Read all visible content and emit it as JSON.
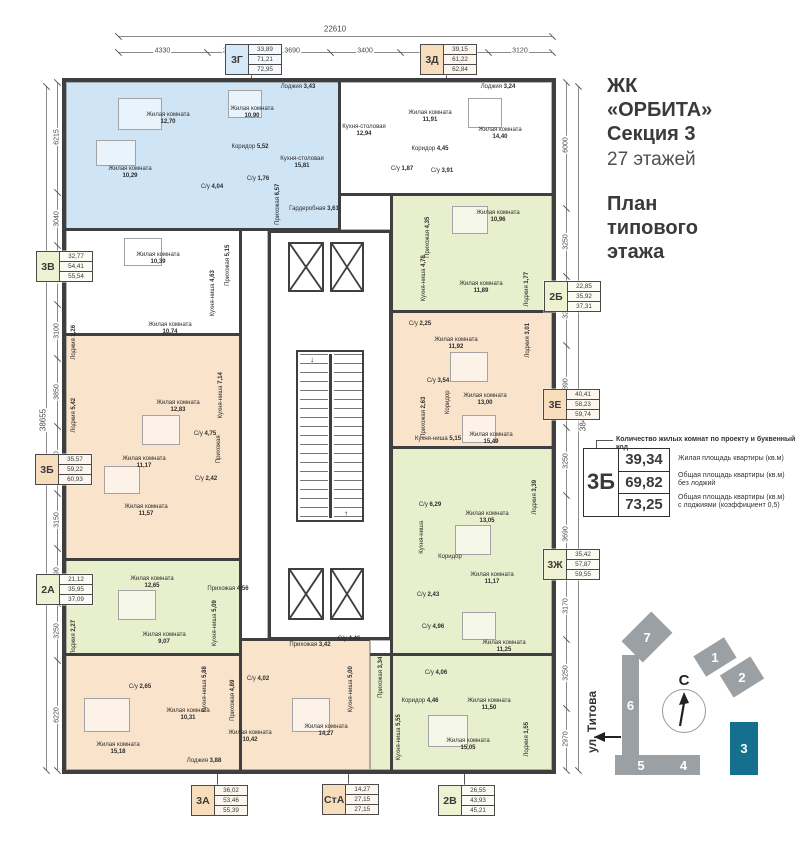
{
  "header": {
    "project_lines": [
      "ЖК",
      "«ОРБИТА»",
      "Секция 3"
    ],
    "floors": "27 этажей",
    "plan_lines": [
      "План",
      "типового",
      "этажа"
    ]
  },
  "legend": {
    "note": "Количество жилых комнат по проекту и буквенный код",
    "code": "3Б",
    "rows": [
      {
        "value": "39,34",
        "desc": "Жилая площадь квартиры (кв.м)"
      },
      {
        "value": "69,82",
        "desc": "Общая площадь квартиры (кв.м)\nбез лоджий"
      },
      {
        "value": "73,25",
        "desc": "Общая площадь квартиры (кв.м)\nс лоджиями (коэффициент 0,5)"
      }
    ]
  },
  "site": {
    "north": "С",
    "street": "ул. Титова",
    "buildings": [
      {
        "label": "1",
        "x": 112,
        "y": 55,
        "w": 36,
        "h": 24,
        "rot": -32
      },
      {
        "label": "2",
        "x": 139,
        "y": 74,
        "w": 36,
        "h": 26,
        "rot": -32
      },
      {
        "label": "3",
        "x": 145,
        "y": 132,
        "w": 28,
        "h": 53,
        "rot": 0,
        "hl": true
      },
      {
        "label": "4",
        "x": 82,
        "y": 165,
        "w": 33,
        "h": 20,
        "rot": 0
      },
      {
        "label": "5",
        "x": 30,
        "y": 165,
        "w": 52,
        "h": 20,
        "rot": 0
      },
      {
        "label": "6",
        "x": 37,
        "y": 65,
        "w": 17,
        "h": 100,
        "rot": 0
      },
      {
        "label": "7",
        "x": 41,
        "y": 32,
        "w": 42,
        "h": 30,
        "rot": -45
      }
    ]
  },
  "colors": {
    "wall": "#3f3f3f",
    "blue": "#cfe4f5",
    "orange": "#f9e3ca",
    "green": "#e8efcd",
    "white": "#ffffff",
    "labelBlue": "#d6e9f8",
    "labelOrange": "#f8ddbd",
    "labelGreen": "#eef2d2",
    "teal": "#15708f",
    "buildingGray": "#9aa0a4"
  },
  "dims": {
    "top": {
      "total": "22610",
      "segments": [
        "4330",
        "2300",
        "3690",
        "3400",
        "4280",
        "3120"
      ]
    },
    "left": {
      "total": "38655",
      "segments": [
        "6215",
        "3040",
        "3290",
        "3100",
        "3850",
        "3750",
        "3150",
        "3090",
        "3250",
        "6220"
      ]
    },
    "right": {
      "total": "38440",
      "segments": [
        "6000",
        "3250",
        "3290",
        "3890",
        "3250",
        "3690",
        "3170",
        "3250",
        "2970"
      ]
    }
  },
  "apartments": [
    {
      "code": "3Г",
      "values": [
        "33,89",
        "71,21",
        "72,95"
      ],
      "theme": "labelBlue",
      "x": 225,
      "y": 44,
      "side": "top"
    },
    {
      "code": "3Д",
      "values": [
        "39,15",
        "61,22",
        "62,84"
      ],
      "theme": "labelOrange",
      "x": 420,
      "y": 44,
      "side": "top"
    },
    {
      "code": "3В",
      "values": [
        "32,77",
        "54,41",
        "55,54"
      ],
      "theme": "labelGreen",
      "x": 36,
      "y": 251,
      "side": "left"
    },
    {
      "code": "3Б",
      "values": [
        "35,57",
        "59,22",
        "60,93"
      ],
      "theme": "labelOrange",
      "x": 35,
      "y": 454,
      "side": "left"
    },
    {
      "code": "2А",
      "values": [
        "21,12",
        "35,95",
        "37,09"
      ],
      "theme": "labelGreen",
      "x": 36,
      "y": 574,
      "side": "left"
    },
    {
      "code": "2Б",
      "values": [
        "22,85",
        "35,92",
        "37,31"
      ],
      "theme": "labelGreen",
      "x": 544,
      "y": 281,
      "side": "right"
    },
    {
      "code": "3Е",
      "values": [
        "40,41",
        "58,23",
        "59,74"
      ],
      "theme": "labelOrange",
      "x": 543,
      "y": 389,
      "side": "right"
    },
    {
      "code": "3Ж",
      "values": [
        "35,42",
        "57,87",
        "59,55"
      ],
      "theme": "labelGreen",
      "x": 543,
      "y": 549,
      "side": "right"
    },
    {
      "code": "3А",
      "values": [
        "36,02",
        "53,46",
        "55,39"
      ],
      "theme": "labelOrange",
      "x": 191,
      "y": 785,
      "side": "bottom"
    },
    {
      "code": "СтА",
      "values": [
        "14,27",
        "27,15",
        "27,15"
      ],
      "theme": "labelOrange",
      "x": 322,
      "y": 784,
      "side": "bottom"
    },
    {
      "code": "2В",
      "values": [
        "26,55",
        "43,93",
        "45,21"
      ],
      "theme": "labelGreen",
      "x": 438,
      "y": 785,
      "side": "bottom"
    }
  ],
  "floor_plan": {
    "zones": [
      {
        "id": "3g",
        "fill": "blue",
        "x": 66,
        "y": 82,
        "w": 274,
        "h": 148
      },
      {
        "id": "3d",
        "fill": "white",
        "x": 340,
        "y": 82,
        "w": 212,
        "h": 113
      },
      {
        "id": "corr-top",
        "fill": "white",
        "x": 340,
        "y": 195,
        "w": 52,
        "h": 35
      },
      {
        "id": "3v",
        "fill": "white",
        "x": 66,
        "y": 230,
        "w": 174,
        "h": 105
      },
      {
        "id": "3b",
        "fill": "orange",
        "x": 66,
        "y": 335,
        "w": 174,
        "h": 225
      },
      {
        "id": "2a",
        "fill": "green",
        "x": 66,
        "y": 560,
        "w": 174,
        "h": 95
      },
      {
        "id": "3a",
        "fill": "orange",
        "x": 66,
        "y": 655,
        "w": 174,
        "h": 115
      },
      {
        "id": "corr-left",
        "fill": "white",
        "x": 240,
        "y": 230,
        "w": 28,
        "h": 410
      },
      {
        "id": "sta",
        "fill": "orange",
        "x": 240,
        "y": 640,
        "w": 130,
        "h": 130
      },
      {
        "id": "sliver",
        "fill": "white",
        "x": 370,
        "y": 640,
        "w": 22,
        "h": 15
      },
      {
        "id": "2v",
        "fill": "green",
        "x": 370,
        "y": 655,
        "w": 182,
        "h": 115
      },
      {
        "id": "3zh",
        "fill": "green",
        "x": 392,
        "y": 448,
        "w": 160,
        "h": 207
      },
      {
        "id": "3e",
        "fill": "orange",
        "x": 392,
        "y": 312,
        "w": 160,
        "h": 136
      },
      {
        "id": "2b",
        "fill": "green",
        "x": 392,
        "y": 195,
        "w": 160,
        "h": 117
      }
    ],
    "walls": [
      [
        66,
        228,
        274,
        3
      ],
      [
        340,
        193,
        212,
        3
      ],
      [
        338,
        82,
        3,
        149
      ],
      [
        239,
        230,
        3,
        540
      ],
      [
        390,
        195,
        3,
        575
      ],
      [
        66,
        333,
        174,
        3
      ],
      [
        66,
        558,
        174,
        3
      ],
      [
        66,
        653,
        174,
        3
      ],
      [
        240,
        638,
        130,
        3
      ],
      [
        370,
        653,
        182,
        3
      ],
      [
        392,
        310,
        160,
        3
      ],
      [
        392,
        446,
        160,
        3
      ]
    ],
    "core": {
      "x": 268,
      "y": 230,
      "w": 124,
      "h": 410
    },
    "elevators": [
      [
        288,
        242,
        36,
        50
      ],
      [
        330,
        242,
        34,
        50
      ],
      [
        288,
        568,
        36,
        52
      ],
      [
        330,
        568,
        34,
        52
      ]
    ],
    "stairs": {
      "x": 296,
      "y": 350,
      "w": 68,
      "h": 172
    },
    "furniture": [
      [
        118,
        98,
        42,
        30
      ],
      [
        228,
        90,
        32,
        26
      ],
      [
        96,
        140,
        38,
        24
      ],
      [
        468,
        98,
        32,
        28
      ],
      [
        452,
        206,
        34,
        26
      ],
      [
        450,
        352,
        36,
        28
      ],
      [
        462,
        415,
        32,
        26
      ],
      [
        455,
        525,
        34,
        28
      ],
      [
        462,
        612,
        32,
        26
      ],
      [
        428,
        715,
        38,
        30
      ],
      [
        292,
        698,
        36,
        32
      ],
      [
        84,
        698,
        44,
        32
      ],
      [
        142,
        415,
        36,
        28
      ],
      [
        104,
        466,
        34,
        26
      ],
      [
        118,
        590,
        36,
        28
      ],
      [
        124,
        238,
        36,
        26
      ]
    ],
    "rooms": [
      {
        "n": "Жилая комната",
        "a": "12,70",
        "x": 168,
        "y": 118
      },
      {
        "n": "Жилая комната",
        "a": "10,90",
        "x": 252,
        "y": 112
      },
      {
        "n": "Жилая комната",
        "a": "10,29",
        "x": 130,
        "y": 172
      },
      {
        "n": "Коридор",
        "a": "5,52",
        "x": 250,
        "y": 150
      },
      {
        "n": "Кухня-столовая",
        "a": "15,81",
        "x": 302,
        "y": 162
      },
      {
        "n": "Лоджия",
        "a": "3,43",
        "x": 298,
        "y": 90
      },
      {
        "n": "С/у",
        "a": "4,04",
        "x": 212,
        "y": 190
      },
      {
        "n": "С/у",
        "a": "1,76",
        "x": 258,
        "y": 182
      },
      {
        "n": "Прихожая",
        "a": "6,57",
        "x": 278,
        "y": 207,
        "v": 1
      },
      {
        "n": "Гардеробная",
        "a": "3,61",
        "x": 314,
        "y": 212
      },
      {
        "n": "Кухня-столовая",
        "a": "12,94",
        "x": 364,
        "y": 130
      },
      {
        "n": "Жилая комната",
        "a": "11,91",
        "x": 430,
        "y": 116
      },
      {
        "n": "Жилая комната",
        "a": "14,40",
        "x": 500,
        "y": 133
      },
      {
        "n": "Коридор",
        "a": "4,45",
        "x": 430,
        "y": 152
      },
      {
        "n": "С/у",
        "a": "3,91",
        "x": 442,
        "y": 174
      },
      {
        "n": "С/у",
        "a": "1,87",
        "x": 402,
        "y": 172
      },
      {
        "n": "Лоджия",
        "a": "3,24",
        "x": 498,
        "y": 90
      },
      {
        "n": "Жилая комната",
        "a": "10,96",
        "x": 498,
        "y": 216
      },
      {
        "n": "Прихожая",
        "a": "4,35",
        "x": 428,
        "y": 240,
        "v": 1
      },
      {
        "n": "Кухня-ниша",
        "a": "4,78",
        "x": 424,
        "y": 281,
        "v": 1
      },
      {
        "n": "Жилая комната",
        "a": "11,89",
        "x": 481,
        "y": 287
      },
      {
        "n": "Лоджия",
        "a": "1,77",
        "x": 527,
        "y": 292,
        "v": 1
      },
      {
        "n": "С/у",
        "a": "2,25",
        "x": 420,
        "y": 327
      },
      {
        "n": "Жилая комната",
        "a": "11,92",
        "x": 456,
        "y": 343
      },
      {
        "n": "Лоджия",
        "a": "3,01",
        "x": 528,
        "y": 343,
        "v": 1
      },
      {
        "n": "С/у",
        "a": "3,54",
        "x": 438,
        "y": 384
      },
      {
        "n": "Жилая комната",
        "a": "13,00",
        "x": 485,
        "y": 399
      },
      {
        "n": "Коридор",
        "a": "",
        "x": 448,
        "y": 405,
        "v": 1
      },
      {
        "n": "Прихожая",
        "a": "2,63",
        "x": 424,
        "y": 420,
        "v": 1
      },
      {
        "n": "Жилая комната",
        "a": "15,49",
        "x": 491,
        "y": 438
      },
      {
        "n": "Кухня-ниша",
        "a": "5,15",
        "x": 438,
        "y": 442
      },
      {
        "n": "С/у",
        "a": "6,29",
        "x": 430,
        "y": 508
      },
      {
        "n": "Жилая комната",
        "a": "13,05",
        "x": 487,
        "y": 517
      },
      {
        "n": "Лоджия",
        "a": "3,39",
        "x": 535,
        "y": 500,
        "v": 1
      },
      {
        "n": "Кухня-ниша",
        "a": "",
        "x": 422,
        "y": 540,
        "v": 1
      },
      {
        "n": "Коридор",
        "a": "",
        "x": 450,
        "y": 560
      },
      {
        "n": "Жилая комната",
        "a": "11,17",
        "x": 492,
        "y": 578
      },
      {
        "n": "С/у",
        "a": "2,43",
        "x": 428,
        "y": 598
      },
      {
        "n": "С/у",
        "a": "4,96",
        "x": 433,
        "y": 630
      },
      {
        "n": "Жилая комната",
        "a": "11,25",
        "x": 504,
        "y": 646
      },
      {
        "n": "Прихожая",
        "a": "3,34",
        "x": 381,
        "y": 680,
        "v": 1
      },
      {
        "n": "С/у",
        "a": "4,06",
        "x": 436,
        "y": 676
      },
      {
        "n": "Коридор",
        "a": "4,46",
        "x": 420,
        "y": 704
      },
      {
        "n": "Жилая комната",
        "a": "11,50",
        "x": 489,
        "y": 704
      },
      {
        "n": "Кухня-ниша",
        "a": "5,55",
        "x": 399,
        "y": 740,
        "v": 1
      },
      {
        "n": "Жилая комната",
        "a": "15,05",
        "x": 468,
        "y": 744
      },
      {
        "n": "Лоджия",
        "a": "1,55",
        "x": 527,
        "y": 742,
        "v": 1
      },
      {
        "n": "Прихожая",
        "a": "3,42",
        "x": 310,
        "y": 648
      },
      {
        "n": "С/у",
        "a": "4,46",
        "x": 349,
        "y": 642
      },
      {
        "n": "С/у",
        "a": "4,02",
        "x": 258,
        "y": 682
      },
      {
        "n": "Кухня-ниша",
        "a": "5,00",
        "x": 351,
        "y": 692,
        "v": 1
      },
      {
        "n": "Жилая комната",
        "a": "14,27",
        "x": 326,
        "y": 730
      },
      {
        "n": "С/у",
        "a": "2,65",
        "x": 140,
        "y": 690
      },
      {
        "n": "Кухня-ниша",
        "a": "5,88",
        "x": 205,
        "y": 692,
        "v": 1
      },
      {
        "n": "Жилая комната",
        "a": "10,31",
        "x": 188,
        "y": 714
      },
      {
        "n": "Прихожая",
        "a": "4,89",
        "x": 233,
        "y": 703,
        "v": 1
      },
      {
        "n": "Жилая комната",
        "a": "10,42",
        "x": 250,
        "y": 736
      },
      {
        "n": "Жилая комната",
        "a": "15,18",
        "x": 118,
        "y": 748
      },
      {
        "n": "Лоджия",
        "a": "3,88",
        "x": 204,
        "y": 764
      },
      {
        "n": "Жилая комната",
        "a": "12,65",
        "x": 152,
        "y": 582
      },
      {
        "n": "Прихожая",
        "a": "4,56",
        "x": 228,
        "y": 592
      },
      {
        "n": "Жилая комната",
        "a": "9,07",
        "x": 164,
        "y": 638
      },
      {
        "n": "Кухня-ниша",
        "a": "5,09",
        "x": 215,
        "y": 626,
        "v": 1
      },
      {
        "n": "Лоджия",
        "a": "2,27",
        "x": 74,
        "y": 640,
        "v": 1
      },
      {
        "n": "Жилая комната",
        "a": "10,39",
        "x": 158,
        "y": 258
      },
      {
        "n": "Прихожая",
        "a": "5,15",
        "x": 228,
        "y": 268,
        "v": 1
      },
      {
        "n": "Кухня-ниша",
        "a": "4,63",
        "x": 213,
        "y": 296,
        "v": 1
      },
      {
        "n": "Жилая комната",
        "a": "10,74",
        "x": 170,
        "y": 328
      },
      {
        "n": "Лоджия",
        "a": "1,26",
        "x": 74,
        "y": 345,
        "v": 1
      },
      {
        "n": "Жилая комната",
        "a": "12,83",
        "x": 178,
        "y": 406
      },
      {
        "n": "Кухня-ниша",
        "a": "7,14",
        "x": 221,
        "y": 398,
        "v": 1
      },
      {
        "n": "С/у",
        "a": "4,75",
        "x": 205,
        "y": 437
      },
      {
        "n": "Жилая комната",
        "a": "11,17",
        "x": 144,
        "y": 462
      },
      {
        "n": "Прихожая",
        "a": "",
        "x": 219,
        "y": 452,
        "v": 1
      },
      {
        "n": "С/у",
        "a": "2,42",
        "x": 206,
        "y": 482
      },
      {
        "n": "Жилая комната",
        "a": "11,57",
        "x": 146,
        "y": 510
      },
      {
        "n": "Лоджия",
        "a": "5,42",
        "x": 74,
        "y": 418,
        "v": 1
      }
    ]
  }
}
